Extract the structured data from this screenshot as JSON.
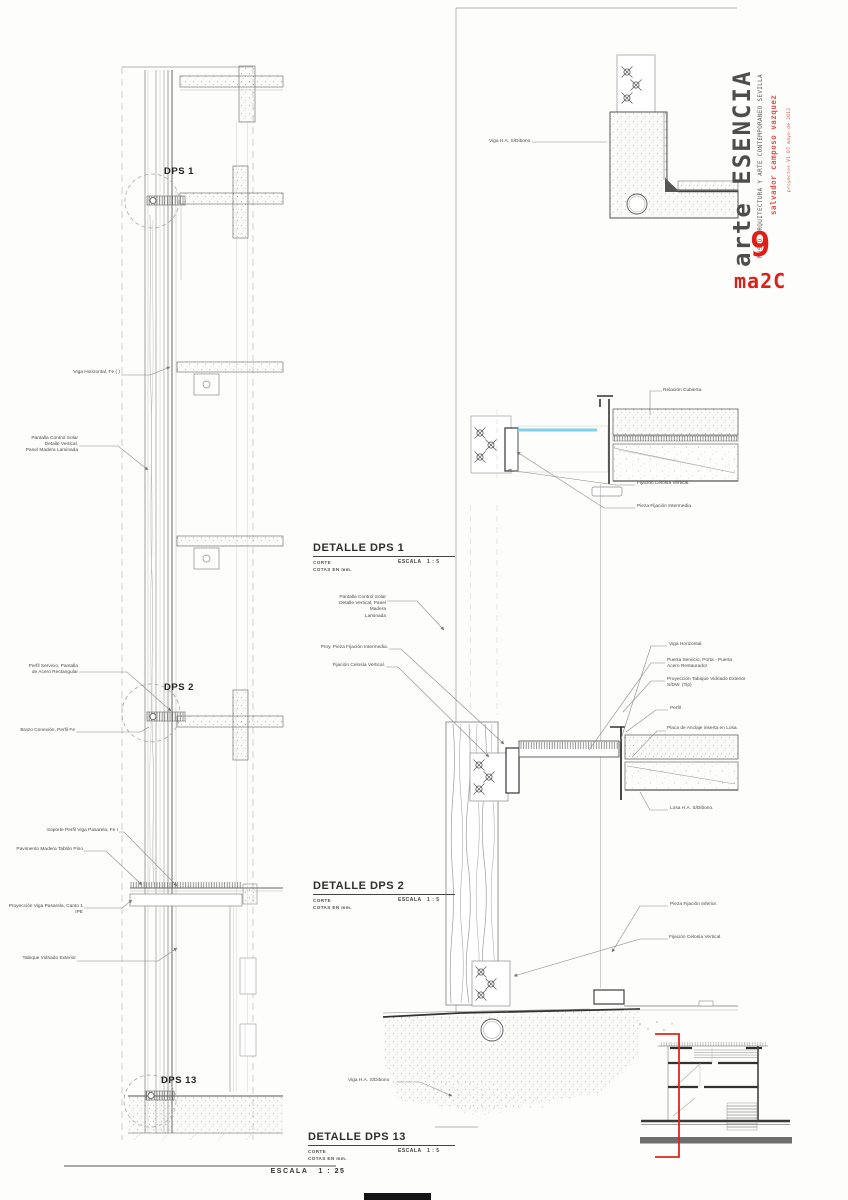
{
  "titleblock": {
    "brand": "arte ESENCIA",
    "subtitle": "MUSEO ARQUITECTURA Y ARTE CONTEMPORANEO SEVILLA",
    "author": "salvador camposo vazquez",
    "course": "proyectos VI 07 mayo de 2012",
    "sheet_number": "9",
    "logo": "ma2C",
    "accent_red": "#dd1f18",
    "ink_gray": "#4d4d4d"
  },
  "left_section": {
    "callouts": [
      "DPS 1",
      "DPS  2",
      "DPS 13"
    ],
    "annotations": [
      "Viga Horizontal, Fe ( )",
      "Pantalla Control Solar\nDetalle Vertical,\nPanel Madera Laminada",
      "Perfil Servicio, Pantalla\nde Acero Rectangular",
      "Brazo Conexión, Perfil Fe",
      "Soporte Perfil Viga Pasarela, Fe I",
      "Pavimento Madera Tablón Pino",
      "Proyección Viga Pasarela, Canto 1 IPE",
      "Tabique Vidriado Exterior"
    ],
    "scale_label": "ESCALA   1 : 25"
  },
  "details": {
    "dps1": {
      "title": "DETALLE DPS 1",
      "type": "CORTE",
      "units": "COTAS EN mm.",
      "scale": "ESCALA   1 : 5"
    },
    "dps2": {
      "title": "DETALLE DPS  2",
      "type": "CORTE",
      "units": "COTAS EN mm.",
      "scale": "ESCALA   1 : 5"
    },
    "dps13": {
      "title": "DETALLE DPS 13",
      "type": "CORTE",
      "units": "COTAS EN mm.",
      "scale": "ESCALA   1 : 5"
    }
  },
  "detail_annotations": [
    "Viga H.A. S/Dibono",
    "Relación Cubierta.",
    "Fijación Celosía Vertical.",
    "Pieza Fijación Intermedia.",
    "Pantalla Control Solar\nDetalle Vertical, Panel Madera\nLaminada",
    "Proy. Pieza Fijación Intermedia.",
    "Fijación Celosía Vertical.",
    "Viga Horizontal.",
    "Puerta Servicio, Porta - Puerta\nAcero Restaurador",
    "Proyección Tabique Vidriado Exterior\nS/DW. (Tip)",
    "Perfil",
    "Placa de Anclaje inserta en Losa.",
    "Losa H.A. S/Dibono.",
    "Pieza Fijación Inferior.",
    "Fijación Celosía Vertical.",
    "Viga H.A. S/Dibono"
  ],
  "colors": {
    "glass_blue": "#7fd0e8",
    "marker_red": "#e0241c"
  }
}
